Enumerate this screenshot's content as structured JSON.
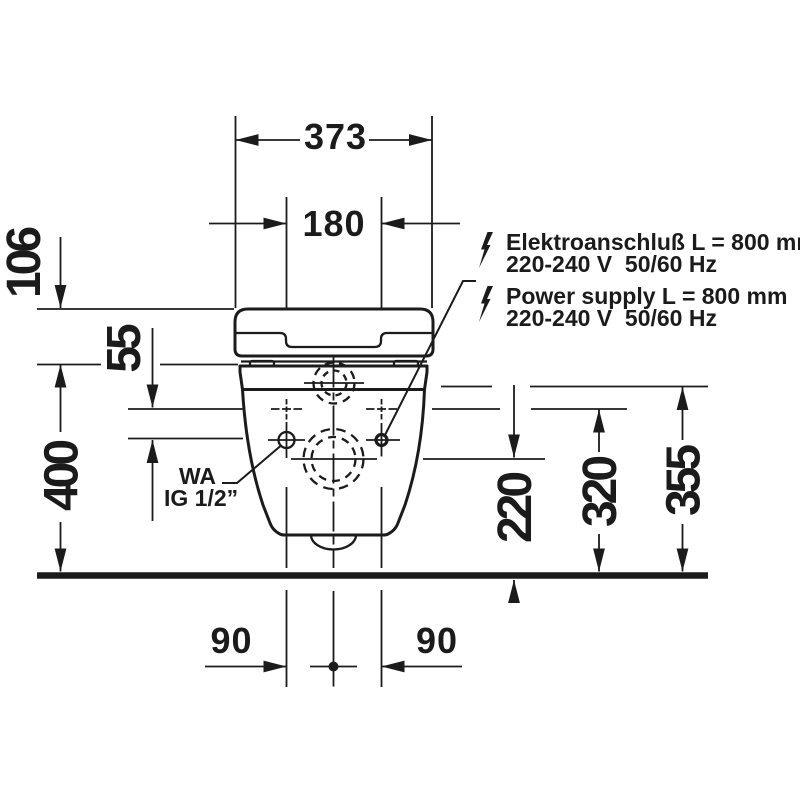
{
  "figure": {
    "type": "technical-installation-drawing",
    "subject": "wall-hung toilet, front view with mounting dimensions",
    "background": "#ffffff",
    "line_color": "#1b1b1b"
  },
  "dimensions": {
    "width_overall": "373",
    "width_holes": "180",
    "height_lid": "106",
    "offset_inlet_holes": "55",
    "height_rim": "400",
    "height_outlet": "220",
    "height_holes": "320",
    "height_inlet": "355",
    "offset_left": "90",
    "offset_right": "90"
  },
  "labels": {
    "water": {
      "line1": "WA",
      "line2": "IG 1/2”"
    },
    "electrical_de": {
      "line1": "Elektroanschluß L = 800 mm",
      "line2": "220-240 V  50/60 Hz"
    },
    "electrical_en": {
      "line1": "Power supply L = 800 mm",
      "line2": "220-240 V  50/60 Hz"
    }
  }
}
